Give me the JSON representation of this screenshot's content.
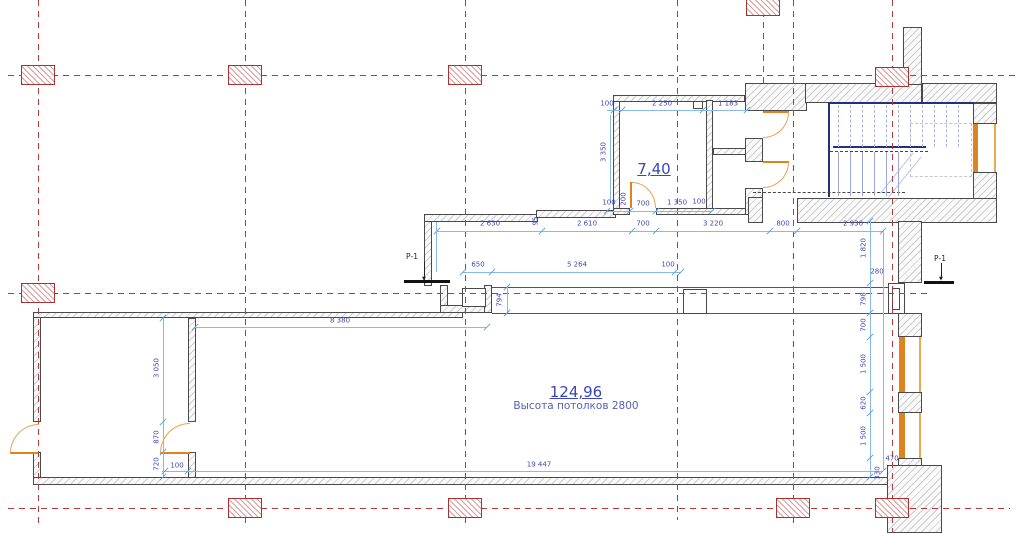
{
  "drawing": {
    "type": "architectural-floor-plan",
    "labels": {
      "room_main_area": "124,96",
      "room_main_subtitle": "Высота потолков 2800",
      "room_small_area": "7,40"
    },
    "colors": {
      "grid_red": "#b23a3a",
      "wall_edge": "#4a4a4a",
      "dim_line_blue": "#8ab9e6",
      "dim_text_blue": "#4049ae",
      "joinery_orange": "#e0821e",
      "stair_blue": "#9aa6dd",
      "stair_navy": "#23307d",
      "room_label_blue": "#3a46bb"
    }
  },
  "grid": {
    "vlines": [
      {
        "x": 38,
        "y0": 0,
        "y1": 525
      },
      {
        "x": 245,
        "y0": 0,
        "y1": 525
      },
      {
        "x": 465,
        "y0": 0,
        "y1": 525
      },
      {
        "x": 677,
        "y0": 0,
        "y1": 520
      },
      {
        "x": 763,
        "y0": 0,
        "y1": 83
      },
      {
        "x": 793,
        "y0": 0,
        "y1": 525
      },
      {
        "x": 892,
        "y0": 0,
        "y1": 533
      }
    ],
    "hlines": [
      {
        "y": 75,
        "x0": 8,
        "x1": 1015
      },
      {
        "y": 293,
        "x0": 8,
        "x1": 930
      },
      {
        "y": 508,
        "x0": 8,
        "x1": 1010
      }
    ],
    "markers": [
      {
        "x": 38,
        "y": 75
      },
      {
        "x": 245,
        "y": 75
      },
      {
        "x": 465,
        "y": 75
      },
      {
        "x": 892,
        "y": 77
      },
      {
        "x": 763,
        "y": 6
      },
      {
        "x": 38,
        "y": 293
      },
      {
        "x": 245,
        "y": 508
      },
      {
        "x": 465,
        "y": 508
      },
      {
        "x": 793,
        "y": 508
      },
      {
        "x": 892,
        "y": 508
      }
    ]
  },
  "section_markers": [
    {
      "label": "Р-1",
      "x": 406,
      "y": 252,
      "line_x": 424,
      "line_y": 262,
      "line_h": 17,
      "tick_x": 404,
      "tick_y": 280,
      "tick_w": 46
    },
    {
      "label": "Р-1",
      "x": 934,
      "y": 254,
      "line_x": 941,
      "line_y": 263,
      "line_h": 16,
      "tick_x": 924,
      "tick_y": 281,
      "tick_w": 30
    }
  ],
  "dim_lines": [
    {
      "d": "h",
      "x": 607,
      "y": 110,
      "len": 141,
      "ticks": [
        614,
        622,
        703,
        747
      ]
    },
    {
      "d": "v",
      "x": 610,
      "y": 115,
      "len": 88,
      "ticks": []
    },
    {
      "d": "h",
      "x": 607,
      "y": 211,
      "len": 105,
      "ticks": [
        607,
        630,
        656,
        712
      ]
    },
    {
      "d": "h",
      "x": 437,
      "y": 231,
      "len": 446,
      "ticks": [
        437,
        542,
        632,
        656,
        770,
        797,
        883
      ]
    },
    {
      "d": "h",
      "x": 463,
      "y": 272,
      "len": 218,
      "ticks": [
        463,
        492,
        675,
        681
      ]
    },
    {
      "d": "v",
      "x": 507,
      "y": 287,
      "len": 26,
      "ticks": [
        287,
        313
      ]
    },
    {
      "d": "h",
      "x": 195,
      "y": 327,
      "len": 292,
      "ticks": [
        195,
        487
      ]
    },
    {
      "d": "v",
      "x": 163,
      "y": 318,
      "len": 159,
      "ticks": [
        318,
        422,
        452,
        477
      ]
    },
    {
      "d": "h",
      "x": 162,
      "y": 471,
      "len": 721,
      "ticks": [
        165,
        188,
        883
      ]
    },
    {
      "d": "v",
      "x": 870,
      "y": 221,
      "len": 256,
      "ticks": [
        221,
        283,
        313,
        337,
        392,
        413,
        458,
        477
      ]
    },
    {
      "d": "v",
      "x": 436,
      "y": 222,
      "len": 50,
      "ticks": []
    },
    {
      "d": "v",
      "x": 883,
      "y": 231,
      "len": 240,
      "ticks": []
    }
  ],
  "dim_labels": [
    {
      "t": "100",
      "x": 607,
      "y": 104
    },
    {
      "t": "2 250",
      "x": 662,
      "y": 104
    },
    {
      "t": "1 183",
      "x": 728,
      "y": 104
    },
    {
      "t": "3 350",
      "x": 604,
      "y": 152,
      "r": 1
    },
    {
      "t": "100",
      "x": 609,
      "y": 203
    },
    {
      "t": "200",
      "x": 624,
      "y": 199,
      "r": 1
    },
    {
      "t": "700",
      "x": 643,
      "y": 204
    },
    {
      "t": "1 350",
      "x": 677,
      "y": 203
    },
    {
      "t": "100",
      "x": 699,
      "y": 202
    },
    {
      "t": "2 630",
      "x": 490,
      "y": 224
    },
    {
      "t": "95",
      "x": 536,
      "y": 221,
      "r": 1
    },
    {
      "t": "2 610",
      "x": 587,
      "y": 224
    },
    {
      "t": "700",
      "x": 643,
      "y": 224
    },
    {
      "t": "3 220",
      "x": 713,
      "y": 224
    },
    {
      "t": "800",
      "x": 783,
      "y": 224
    },
    {
      "t": "2 930",
      "x": 853,
      "y": 224
    },
    {
      "t": "650",
      "x": 478,
      "y": 265
    },
    {
      "t": "5 264",
      "x": 577,
      "y": 265
    },
    {
      "t": "100",
      "x": 668,
      "y": 265
    },
    {
      "t": "794",
      "x": 500,
      "y": 300,
      "r": 1
    },
    {
      "t": "8 380",
      "x": 340,
      "y": 321
    },
    {
      "t": "3 050",
      "x": 157,
      "y": 368,
      "r": 1
    },
    {
      "t": "870",
      "x": 157,
      "y": 437,
      "r": 1
    },
    {
      "t": "720",
      "x": 157,
      "y": 464,
      "r": 1
    },
    {
      "t": "100",
      "x": 177,
      "y": 466
    },
    {
      "t": "19 447",
      "x": 539,
      "y": 465
    },
    {
      "t": "1 820",
      "x": 864,
      "y": 248,
      "r": 1
    },
    {
      "t": "280",
      "x": 877,
      "y": 272
    },
    {
      "t": "798",
      "x": 864,
      "y": 299,
      "r": 1
    },
    {
      "t": "700",
      "x": 864,
      "y": 325,
      "r": 1
    },
    {
      "t": "1 500",
      "x": 864,
      "y": 364,
      "r": 1
    },
    {
      "t": "620",
      "x": 864,
      "y": 403,
      "r": 1
    },
    {
      "t": "1 500",
      "x": 864,
      "y": 436,
      "r": 1
    },
    {
      "t": "470",
      "x": 892,
      "y": 459
    },
    {
      "t": "330",
      "x": 878,
      "y": 473,
      "r": 1
    }
  ],
  "stairs": {
    "upper": {
      "x0": 838,
      "dx": 12,
      "n": 11,
      "y": 105,
      "h": 42,
      "dashed": true
    },
    "lower": {
      "x0": 838,
      "dx": 12,
      "n": 6,
      "y": 152,
      "h": 44,
      "dashed": false
    }
  }
}
